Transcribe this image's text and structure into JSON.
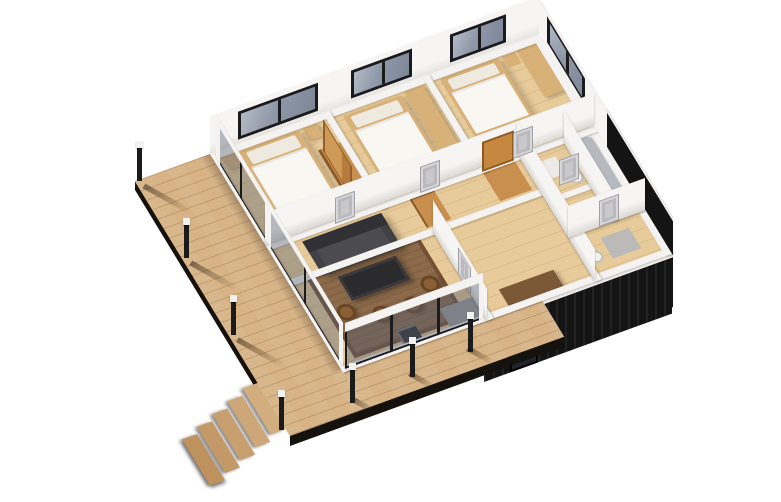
{
  "title": "isometric-3d-floor-plan-render",
  "palette": {
    "background": "#ffffff",
    "deck-wood": "#d7b385",
    "floor-wood": "#e8cb9b",
    "wall-white": "#f4f3f1",
    "facade-black": "#141414",
    "glass-blue": "#8f98a8",
    "frame-black": "#1b1b1e",
    "door-gray": "#c9c9cc",
    "rug-brown": "#8c6a4a",
    "rug-border": "#754f34",
    "sofa-dark": "#414145",
    "table-dark": "#2b2a2d",
    "chair-brown": "#8a5f35",
    "wood-tan": "#d8b178",
    "wardrobe-orange": "#c98f4f",
    "counter-gray": "#9d9d9b",
    "tub-gray": "#b6bac0",
    "post-black": "#1b1b1b",
    "post-cap": "#f1f1ef"
  },
  "scene": {
    "type": "architectural 3d cutaway floor plan, isometric view from south-west",
    "building": {
      "exterior_cladding": "black",
      "interior_walls": "white",
      "flooring": "light wood",
      "rooms": [
        {
          "name": "bedroom-1",
          "furniture": [
            "double-bed",
            "nightstand",
            "nightstand",
            "foot-bench",
            "tall-wardrobe"
          ]
        },
        {
          "name": "bedroom-2",
          "furniture": [
            "double-bed",
            "desk-bench"
          ]
        },
        {
          "name": "bedroom-3",
          "furniture": [
            "double-bed",
            "nightstand",
            "wall-bench"
          ]
        },
        {
          "name": "hallway",
          "furniture": [
            "closet",
            "closet",
            "interior-doors"
          ]
        },
        {
          "name": "living-room",
          "furniture": [
            "sofa",
            "coffee-table",
            "armchair",
            "armchair",
            "armchair",
            "armchair",
            "rug",
            "stove",
            "counter"
          ]
        },
        {
          "name": "entry-dining",
          "furniture": [
            "sideboard"
          ]
        },
        {
          "name": "bathroom",
          "furniture": [
            "bathtub",
            "toilet",
            "mat"
          ]
        },
        {
          "name": "wc",
          "furniture": [
            "toilet",
            "mat"
          ]
        }
      ],
      "windows": {
        "north_wall": 3,
        "east_wall": 1,
        "glazed_walls": [
          "west-side",
          "living-room-south"
        ]
      },
      "interior_door_count": 6
    },
    "deck": {
      "shape": "L-shaped wrap-around wooden terrace on west and south sides",
      "railing_posts": 7,
      "stairs": {
        "steps": 5,
        "direction": "descending to the south-west"
      }
    }
  }
}
